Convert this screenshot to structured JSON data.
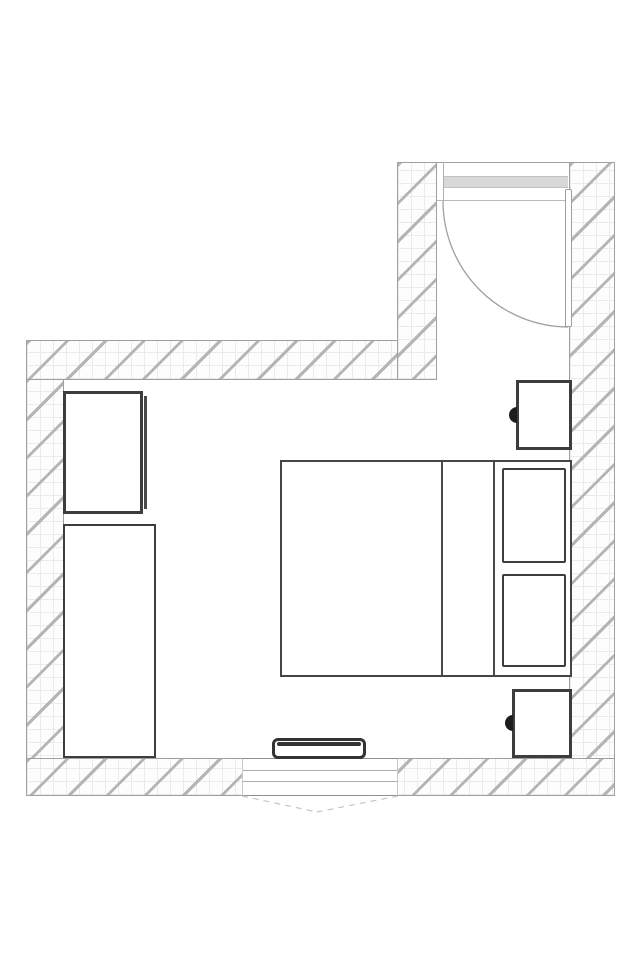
{
  "canvas": {
    "label": "Bedroom floor plan",
    "width_px": 640,
    "height_px": 960
  },
  "colors": {
    "wall_hatch": "#b5b5b5",
    "wall_grid": "#ebebeb",
    "wall_border": "#a0a0a0",
    "furniture_border": "#3d3d3d",
    "bed_border": "#454545",
    "door_panel": "#d8d8d8",
    "door_arc": "#9f9f9f",
    "dash_line": "#c6c6c6",
    "knob": "#1d1d1d",
    "radiator_core": "#333333"
  },
  "elements": {
    "walls": {
      "label": "hatched exterior walls"
    },
    "door": {
      "label": "entry door (open, 90-degree swing)"
    },
    "door_panel": {
      "label": "door panel in frame"
    },
    "door_leaf": {
      "label": "open door leaf"
    },
    "door_arc": {
      "label": "door swing arc"
    },
    "window": {
      "label": "window"
    },
    "window_dashes": {
      "label": "window opening projection"
    },
    "bed": {
      "label": "double bed"
    },
    "bed_fold": {
      "label": "blanket fold line"
    },
    "headboard": {
      "label": "headboard line"
    },
    "pillow_top": {
      "label": "pillow"
    },
    "pillow_bottom": {
      "label": "pillow"
    },
    "nightstand_top": {
      "label": "nightstand with knob"
    },
    "nightstand_bottom": {
      "label": "nightstand with knob"
    },
    "knob": {
      "label": "knob"
    },
    "wardrobe": {
      "label": "wardrobe"
    },
    "wardrobe_door": {
      "label": "wardrobe door line"
    },
    "cabinet": {
      "label": "tall cabinet"
    },
    "radiator": {
      "label": "radiator / low bench"
    }
  }
}
